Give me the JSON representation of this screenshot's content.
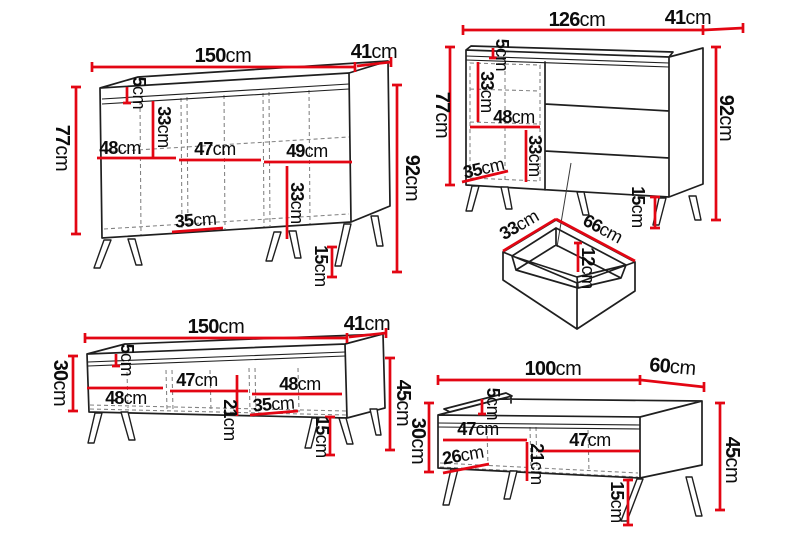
{
  "sheet": {
    "name": "furniture-dimensions-diagram",
    "background": "#ffffff"
  },
  "colors": {
    "dimension_line": "#e30613",
    "outline": "#1f1f1f",
    "hidden_line": "#818181"
  },
  "unit": "cm",
  "pieces": {
    "sideboard": {
      "width": {
        "v": "150",
        "u": "cm"
      },
      "depth": {
        "v": "41",
        "u": "cm"
      },
      "body_height": {
        "v": "77",
        "u": "cm"
      },
      "total_height": {
        "v": "92",
        "u": "cm"
      },
      "top_offset": {
        "v": "5",
        "u": "cm"
      },
      "upper_inner_height": {
        "v": "33",
        "u": "cm"
      },
      "section_left": {
        "v": "48",
        "u": "cm"
      },
      "section_middle": {
        "v": "47",
        "u": "cm"
      },
      "section_right": {
        "v": "49",
        "u": "cm"
      },
      "lower_inner_height": {
        "v": "33",
        "u": "cm"
      },
      "lower_inner_width": {
        "v": "35",
        "u": "cm"
      },
      "leg_height": {
        "v": "15",
        "u": "cm"
      }
    },
    "chest": {
      "width": {
        "v": "126",
        "u": "cm"
      },
      "depth": {
        "v": "41",
        "u": "cm"
      },
      "body_height": {
        "v": "77",
        "u": "cm"
      },
      "total_height": {
        "v": "92",
        "u": "cm"
      },
      "top_offset": {
        "v": "5",
        "u": "cm"
      },
      "upper_inner_height": {
        "v": "33",
        "u": "cm"
      },
      "inner_width": {
        "v": "48",
        "u": "cm"
      },
      "lower_inner_height": {
        "v": "33",
        "u": "cm"
      },
      "bottom_inner_width": {
        "v": "35",
        "u": "cm"
      },
      "leg_height": {
        "v": "15",
        "u": "cm"
      }
    },
    "drawer": {
      "side_depth": {
        "v": "33",
        "u": "cm"
      },
      "front_width": {
        "v": "66",
        "u": "cm"
      },
      "inner_depth": {
        "v": "12",
        "u": "cm"
      }
    },
    "tv_stand": {
      "width": {
        "v": "150",
        "u": "cm"
      },
      "depth": {
        "v": "41",
        "u": "cm"
      },
      "front_height": {
        "v": "30",
        "u": "cm"
      },
      "total_height": {
        "v": "45",
        "u": "cm"
      },
      "top_offset": {
        "v": "5",
        "u": "cm"
      },
      "section_left": {
        "v": "48",
        "u": "cm"
      },
      "section_middle": {
        "v": "47",
        "u": "cm"
      },
      "section_right": {
        "v": "48",
        "u": "cm"
      },
      "lower_inner_width": {
        "v": "35",
        "u": "cm"
      },
      "inner_height": {
        "v": "21",
        "u": "cm"
      },
      "leg_height": {
        "v": "15",
        "u": "cm"
      }
    },
    "coffee_table": {
      "width": {
        "v": "100",
        "u": "cm"
      },
      "depth": {
        "v": "60",
        "u": "cm"
      },
      "front_height": {
        "v": "30",
        "u": "cm"
      },
      "total_height": {
        "v": "45",
        "u": "cm"
      },
      "top_offset": {
        "v": "5",
        "u": "cm"
      },
      "section_left": {
        "v": "47",
        "u": "cm"
      },
      "section_right": {
        "v": "47",
        "u": "cm"
      },
      "lower_inner_width": {
        "v": "26",
        "u": "cm"
      },
      "inner_height": {
        "v": "21",
        "u": "cm"
      },
      "leg_height": {
        "v": "15",
        "u": "cm"
      }
    }
  }
}
